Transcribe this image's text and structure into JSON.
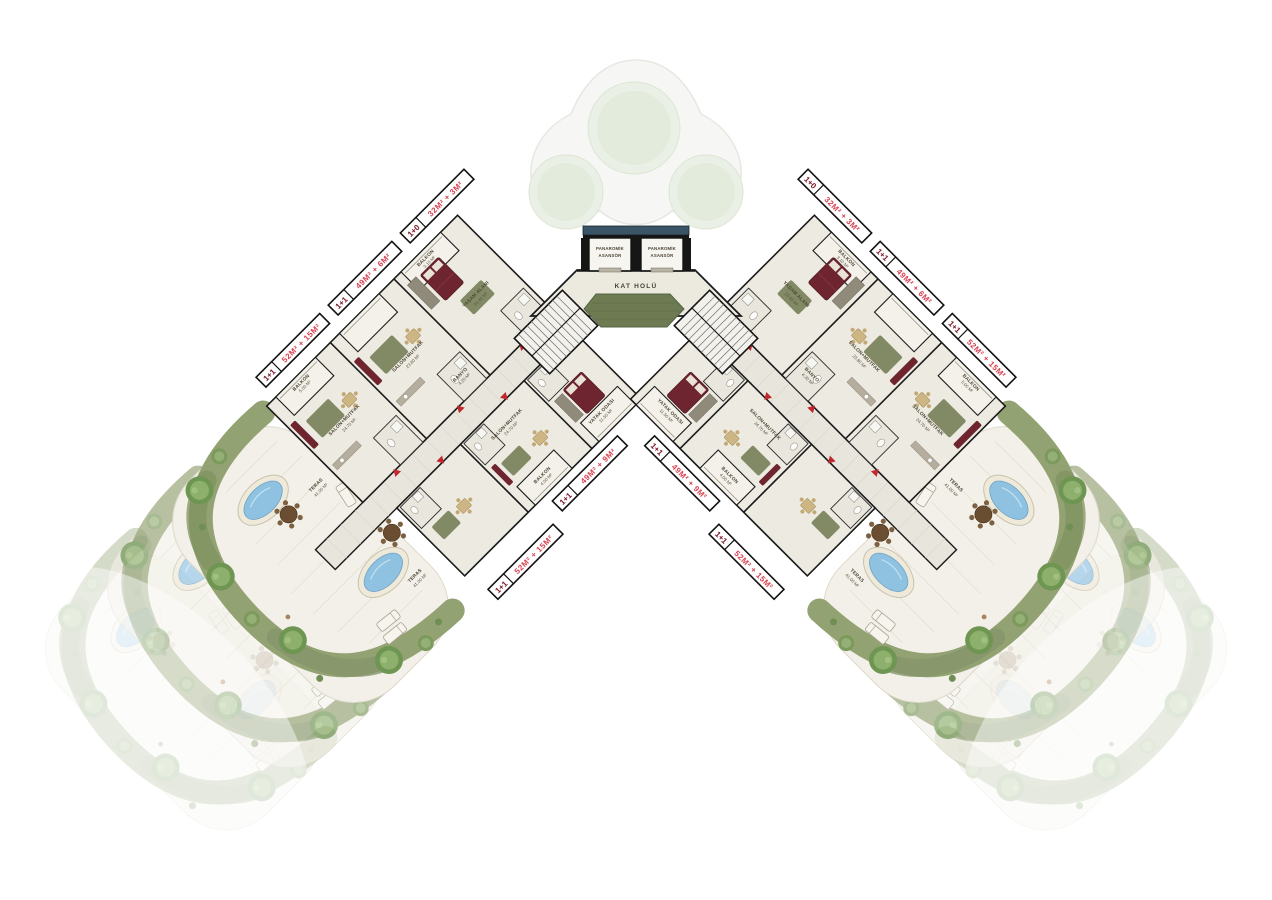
{
  "core": {
    "elevator_line1": "PANAROMİK",
    "elevator_line2": "ASANSÖR",
    "hall_label": "KAT HOLÜ"
  },
  "strips": {
    "outer": [
      {
        "type": "1+0",
        "area": "32M² + 3M²"
      },
      {
        "type": "1+1",
        "area": "49M² + 6M²"
      },
      {
        "type": "1+1",
        "area": "52M² + 15M²"
      }
    ],
    "inner": [
      {
        "type": "1+1",
        "area": "49M² + 9M²"
      },
      {
        "type": "1+1",
        "area": "52M² + 15M²"
      }
    ]
  },
  "rooms": {
    "yasam_alani": {
      "name": "YAŞAM ALANI",
      "area": "25.85 M²"
    },
    "salon_mutfak_a": {
      "name": "SALON+MUTFAK",
      "area": "23.80 M²"
    },
    "salon_mutfak_b": {
      "name": "SALON+MUTFAK",
      "area": "24.70 M²"
    },
    "yatak_odasi": {
      "name": "YATAK ODASI",
      "area": "11.50 M²"
    },
    "banyo": {
      "name": "BANYO",
      "area": "4.20 M²"
    },
    "balkon_a": {
      "name": "BALKON",
      "area": "3.10 M²"
    },
    "balkon_b": {
      "name": "BALKON",
      "area": "5.00 M²"
    },
    "balkon_c": {
      "name": "BALKON",
      "area": "4.00 M²"
    },
    "teras": {
      "name": "TERAS",
      "area": "41.00 M²"
    }
  },
  "colors": {
    "floor": "#edeae1",
    "corridor": "#e7e5dc",
    "wall": "#1b1b1b",
    "furniture_maroon": "#6e2530",
    "rug_olive": "#77815a",
    "garden_green": "#93a272",
    "tree_green": "#6f9553",
    "pool_water": "#8fc2e1",
    "pool_rim": "#efe9da",
    "strip_type_red": "#7c1325",
    "strip_area_red": "#d8414f",
    "elevator_band": "#3a5666",
    "hall_floor": "#eceade",
    "hex_green": "#6d7a52"
  }
}
